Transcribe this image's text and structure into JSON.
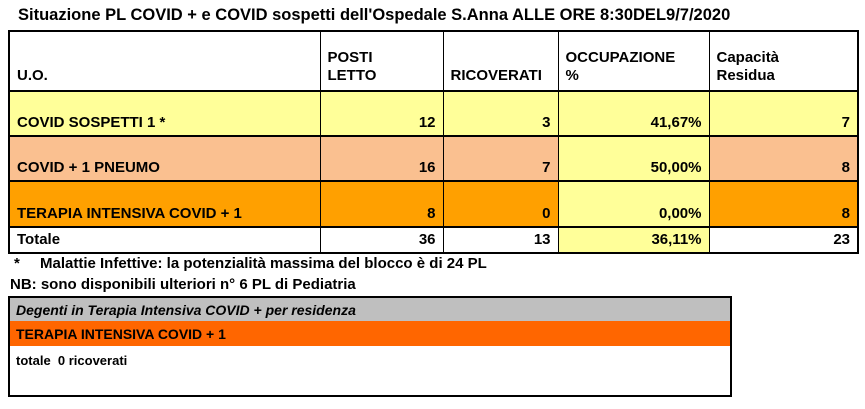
{
  "title": "Situazione PL COVID + e COVID sospetti dell'Ospedale S.Anna ALLE ORE 8:30DEL9/7/2020",
  "bed_table": {
    "headers": {
      "uo": "U.O.",
      "posti_letto": "POSTI LETTO",
      "ricoverati": "RICOVERATI",
      "occupazione": "OCCUPAZIONE %",
      "capacita_residua": "Capacità Residua"
    },
    "rows": [
      {
        "uo": "COVID SOSPETTI 1 *",
        "posti_letto": "12",
        "ricoverati": "3",
        "occupazione": "41,67%",
        "capacita_residua": "7"
      },
      {
        "uo": "COVID + 1 PNEUMO",
        "posti_letto": "16",
        "ricoverati": "7",
        "occupazione": "50,00%",
        "capacita_residua": "8"
      },
      {
        "uo": "TERAPIA INTENSIVA COVID + 1",
        "posti_letto": "8",
        "ricoverati": "0",
        "occupazione": "0,00%",
        "capacita_residua": "8"
      }
    ],
    "total": {
      "uo": "Totale",
      "posti_letto": "36",
      "ricoverati": "13",
      "occupazione": "36,11%",
      "capacita_residua": "23"
    }
  },
  "footnotes": {
    "star_marker": "*",
    "star_text": "Malattie Infettive: la potenzialità massima del blocco è di 24 PL",
    "nb_text": "NB: sono disponibili ulteriori n° 6 PL di Pediatria"
  },
  "residence_box": {
    "header": "Degenti in Terapia Intensiva COVID + per residenza",
    "ward": "TERAPIA INTENSIVA COVID + 1",
    "total_line": "totale  0 ricoverati"
  },
  "colors": {
    "row_covid_sospetti_bg": "#FFFF99",
    "row_covid_pneumo_bg": "#FAC090",
    "row_terapia_intensiva_bg": "#FFA000",
    "occupazione_column_bg": "#FFFF99",
    "residence_header_bg": "#BFBFBF",
    "residence_ward_bg": "#FF6600",
    "border": "#000000"
  }
}
